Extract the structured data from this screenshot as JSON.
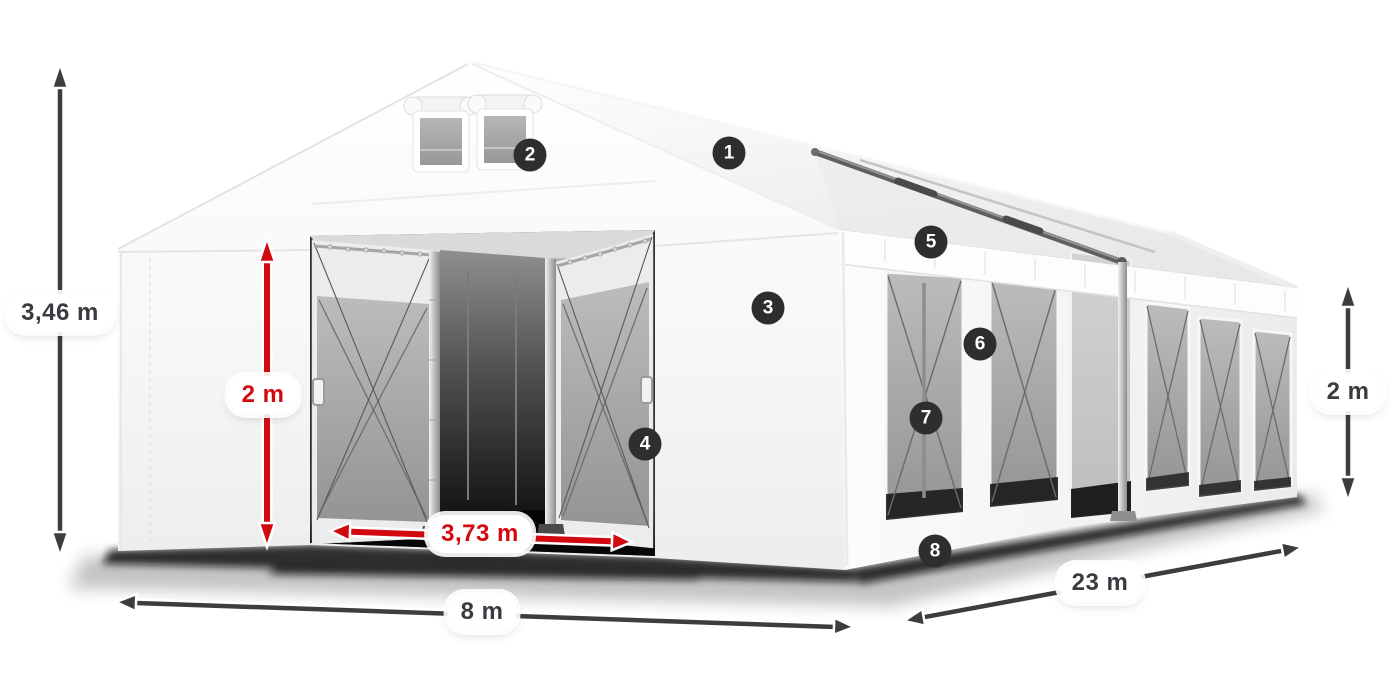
{
  "illustration": {
    "name": "marquee-tent-3d-view"
  },
  "colors": {
    "accent_red": "#d20a10",
    "arrow_dark": "#3d3d3d",
    "badge_background": "#2e2e2e",
    "badge_text": "#ffffff",
    "label_background": "#ffffff",
    "label_text_dark": "#383c40"
  },
  "dimensions": [
    {
      "id": "total-height",
      "label": "3,46 m",
      "style": "dark"
    },
    {
      "id": "entrance-height",
      "label": "2 m",
      "style": "red"
    },
    {
      "id": "entrance-width",
      "label": "3,73 m",
      "style": "red"
    },
    {
      "id": "gable-width",
      "label": "8 m",
      "style": "dark"
    },
    {
      "id": "side-length",
      "label": "23 m",
      "style": "dark"
    },
    {
      "id": "side-wall-height",
      "label": "2 m",
      "style": "dark"
    }
  ],
  "callouts": [
    {
      "number": "1"
    },
    {
      "number": "2"
    },
    {
      "number": "3"
    },
    {
      "number": "4"
    },
    {
      "number": "5"
    },
    {
      "number": "6"
    },
    {
      "number": "7"
    },
    {
      "number": "8"
    }
  ]
}
